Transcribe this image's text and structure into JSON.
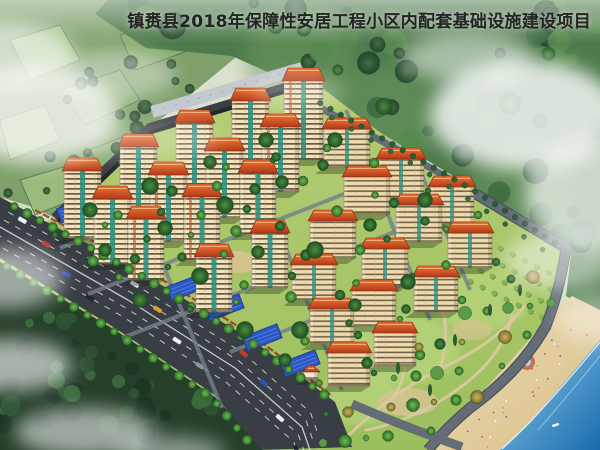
{
  "title": {
    "text": "镇赉县2018年保障性安居工程小区内配套基础设施建设项目"
  },
  "scene_type": "aerial-architectural-rendering",
  "palette": {
    "haze_top": "#dfe4d2",
    "haze_bottom": "#c9d4b8",
    "hill_green": "#7fa06b",
    "field_light": "#9abb7d",
    "field_mid": "#87aa6e",
    "forest_base": "#4d7a4b",
    "forest_dark_base": "#263f2a",
    "ground_light": "#b5cd74",
    "ground_deep": "#9cbf5e",
    "road_asphalt": "#383e44",
    "road_small": "#747f8b",
    "shore_road": "#646d76",
    "roof_top": "#ef7434",
    "roof_bottom": "#b03a18",
    "facade_cream": "#f1e3bb",
    "facade_band": "#6b5740",
    "glass_teal": "#2f8f7e",
    "ramp_blue": "#2d55c4",
    "fence_red": "#a44a2a",
    "wall_dark": "#3a3f45",
    "wall_roof_gray": "#c3c9cf",
    "beach_sand": "#ecdcb4",
    "beach_deep": "#d9c08c",
    "water_near": "#8ecfee",
    "water_deep": "#1a6aad",
    "path_tan": "#dbc9a0",
    "plaza_tan": "#d8c28e",
    "pond_teal": "#245a66",
    "mist_white": "#ffffff",
    "title_color": "#242424"
  }
}
